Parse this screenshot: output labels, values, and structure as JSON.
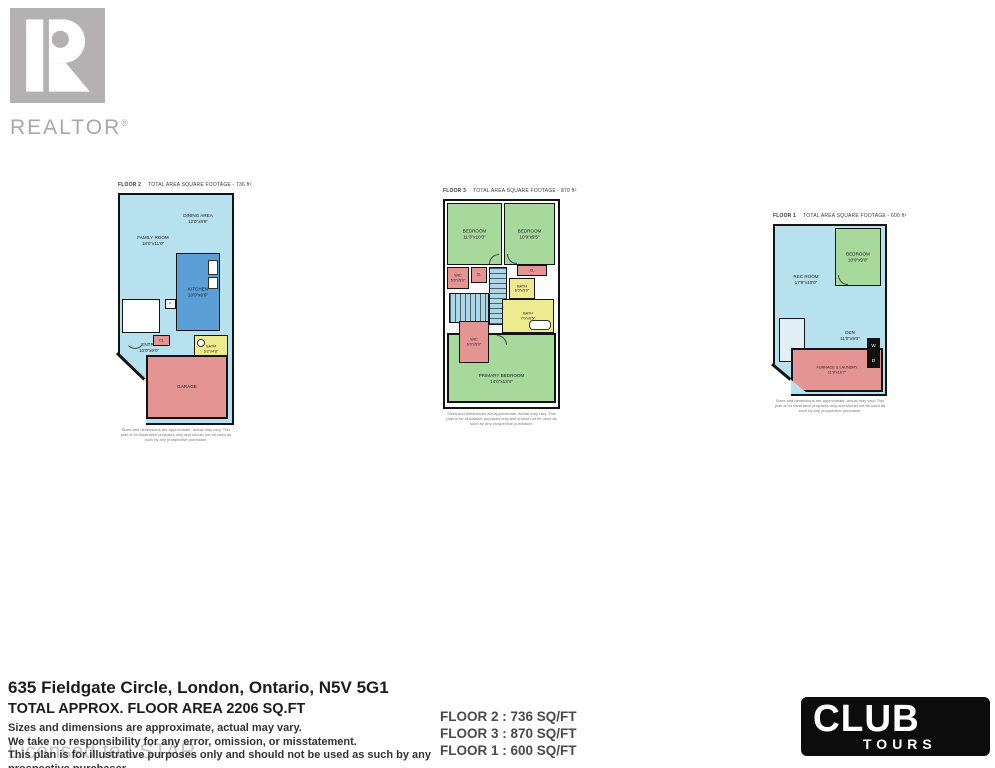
{
  "branding": {
    "realtor": {
      "label": "REALTOR",
      "reg": "®"
    },
    "club_tours": {
      "line1": "CLUB",
      "line2": "TOURS"
    },
    "watermark": "Licensed to LSTAR"
  },
  "colors": {
    "room-cyan": "#b7e1ee",
    "room-blue": "#5c9fd6",
    "room-green": "#a7d89c",
    "room-yellow": "#eeea8e",
    "room-pink": "#e59494",
    "stairs-blue": "#abd7e8",
    "wall": "#141414",
    "logo-gray": "#b3b1b1"
  },
  "plans": [
    {
      "label": "FLOOR 2",
      "area_text": "TOTAL AREA SQUARE FOOTAGE - 736 ft²",
      "disclaimer": "Sizes and dimensions are approximate, actual may vary. This plan is for illustrative purposes only and should not be used as such by any prospective purchaser.",
      "rooms": {
        "dining": {
          "name": "DINING AREA",
          "dims": "12'0\"x9'9\""
        },
        "family": {
          "name": "FAMILY ROOM",
          "dims": "18'0\"x11'0\""
        },
        "kitchen": {
          "name": "KITCHEN",
          "dims": "10'0\"x9'9\""
        },
        "entry": {
          "name": "ENTRY",
          "dims": "10'0\"x9'0\""
        },
        "cl": {
          "name": "CL"
        },
        "bath": {
          "name": "BATH",
          "dims": "5'2\"x4'9\""
        },
        "garage": {
          "name": "GARAGE"
        },
        "fridge": {
          "name": "F"
        }
      }
    },
    {
      "label": "FLOOR 3",
      "area_text": "TOTAL AREA SQUARE FOOTAGE - 870 ft²",
      "disclaimer": "Sizes and dimensions are approximate, actual may vary. This plan is for illustrative purposes only and should not be used as such by any prospective purchaser.",
      "rooms": {
        "bedroom1": {
          "name": "BEDROOM",
          "dims": "11'3\"x10'0\""
        },
        "bedroom2": {
          "name": "BEDROOM",
          "dims": "10'9\"x9'5\""
        },
        "wic1": {
          "name": "WIC",
          "dims": "5'0\"x5'0\""
        },
        "cl1": {
          "name": "CL"
        },
        "cl2": {
          "name": "CL"
        },
        "bath1": {
          "name": "BATH",
          "dims": "6'0\"x5'0\""
        },
        "bath2": {
          "name": "BATH",
          "dims": "7'0\"x6'5\""
        },
        "wic2": {
          "name": "WIC",
          "dims": "6'0\"x5'0\""
        },
        "primary": {
          "name": "PRIMARY BEDROOM",
          "dims": "14'0\"x13'4\""
        }
      }
    },
    {
      "label": "FLOOR 1",
      "area_text": "TOTAL AREA SQUARE FOOTAGE - 600 ft²",
      "disclaimer": "Sizes and dimensions are approximate, actual may vary. This plan is for illustrative purposes only and should not be used as such by any prospective purchaser.",
      "rooms": {
        "rec": {
          "name": "REC ROOM",
          "dims": "17'9\"x10'0\""
        },
        "bedroom": {
          "name": "BEDROOM",
          "dims": "10'9\"x9'0\""
        },
        "den": {
          "name": "DEN",
          "dims": "11'0\"x9'0\""
        },
        "furnace": {
          "name": "FURNACE & LAUNDRY",
          "dims": "11'9\"x10'7\""
        },
        "washer": {
          "name": "W"
        },
        "dryer": {
          "name": "D"
        }
      }
    }
  ],
  "address": {
    "title": "635 Fieldgate Circle, London, Ontario, N5V 5G1",
    "total_area": "TOTAL APPROX. FLOOR AREA 2206 SQ.FT",
    "disclaimer_lines": [
      "Sizes and dimensions are approximate, actual may vary.",
      "We take no responsibility for any error, omission, or misstatement.",
      "This plan is for illustrative purposes only and should not be used as such by any prospective purchaser."
    ]
  },
  "summary": {
    "lines": [
      "FLOOR 2 : 736 SQ/FT",
      "FLOOR 3 : 870 SQ/FT",
      "FLOOR 1 : 600 SQ/FT"
    ]
  }
}
